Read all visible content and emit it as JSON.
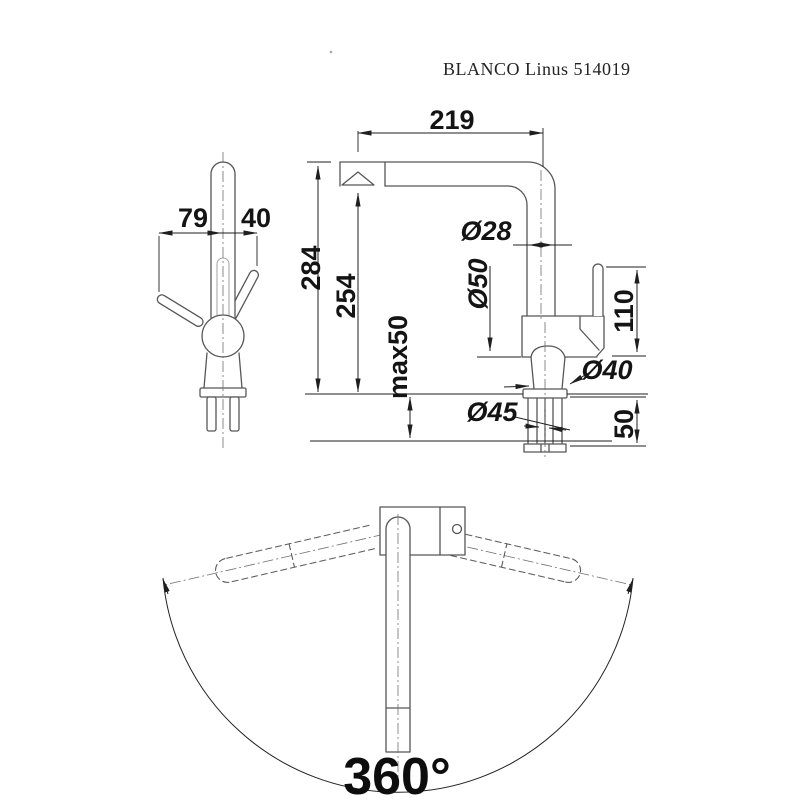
{
  "title": "BLANCO Linus 514019",
  "side_view": {
    "dim_lever_front": "79",
    "dim_lever_back": "40"
  },
  "front_view": {
    "dim_reach": "219",
    "dim_height_total": "284",
    "dim_height_spout": "254",
    "dim_counter_thickness": "max50",
    "dim_spout_tube_diameter": "Ø28",
    "dim_body_diameter": "Ø50",
    "dim_lever_length": "110",
    "dim_base_diameter": "Ø40",
    "dim_shank_diameter": "Ø45",
    "dim_shank_length": "50"
  },
  "bottom_view": {
    "dim_swivel_angle": "360°"
  },
  "colors": {
    "outline": "#565656",
    "dimension": "#1f1f1f",
    "background": "#ffffff"
  }
}
